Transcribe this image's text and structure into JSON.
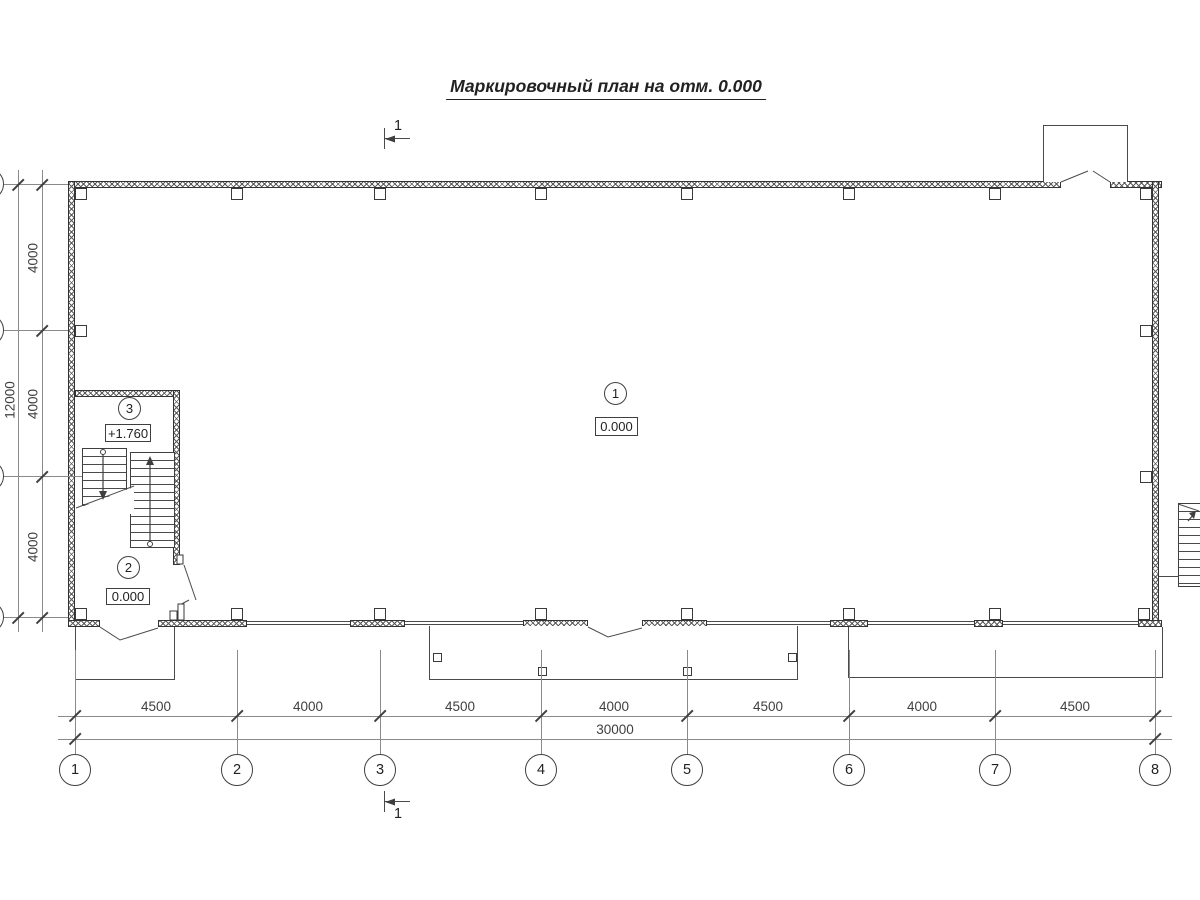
{
  "title": "Маркировочный план на отм. 0.000",
  "section": {
    "label": "1"
  },
  "grid": {
    "column_axes": [
      "1",
      "2",
      "3",
      "4",
      "5",
      "6",
      "7",
      "8"
    ],
    "column_spacing_labels": [
      "4500",
      "4000",
      "4500",
      "4000",
      "4500",
      "4000",
      "4500"
    ],
    "column_total_label": "30000",
    "row_spacing_labels": [
      "4000",
      "4000",
      "4000"
    ],
    "row_total_label": "12000"
  },
  "rooms": [
    {
      "number": "1",
      "level": "0.000"
    },
    {
      "number": "2",
      "level": "0.000"
    },
    {
      "number": "3",
      "level": "+1.760"
    }
  ],
  "colors": {
    "line": "#3f3f3f",
    "background": "#ffffff"
  }
}
